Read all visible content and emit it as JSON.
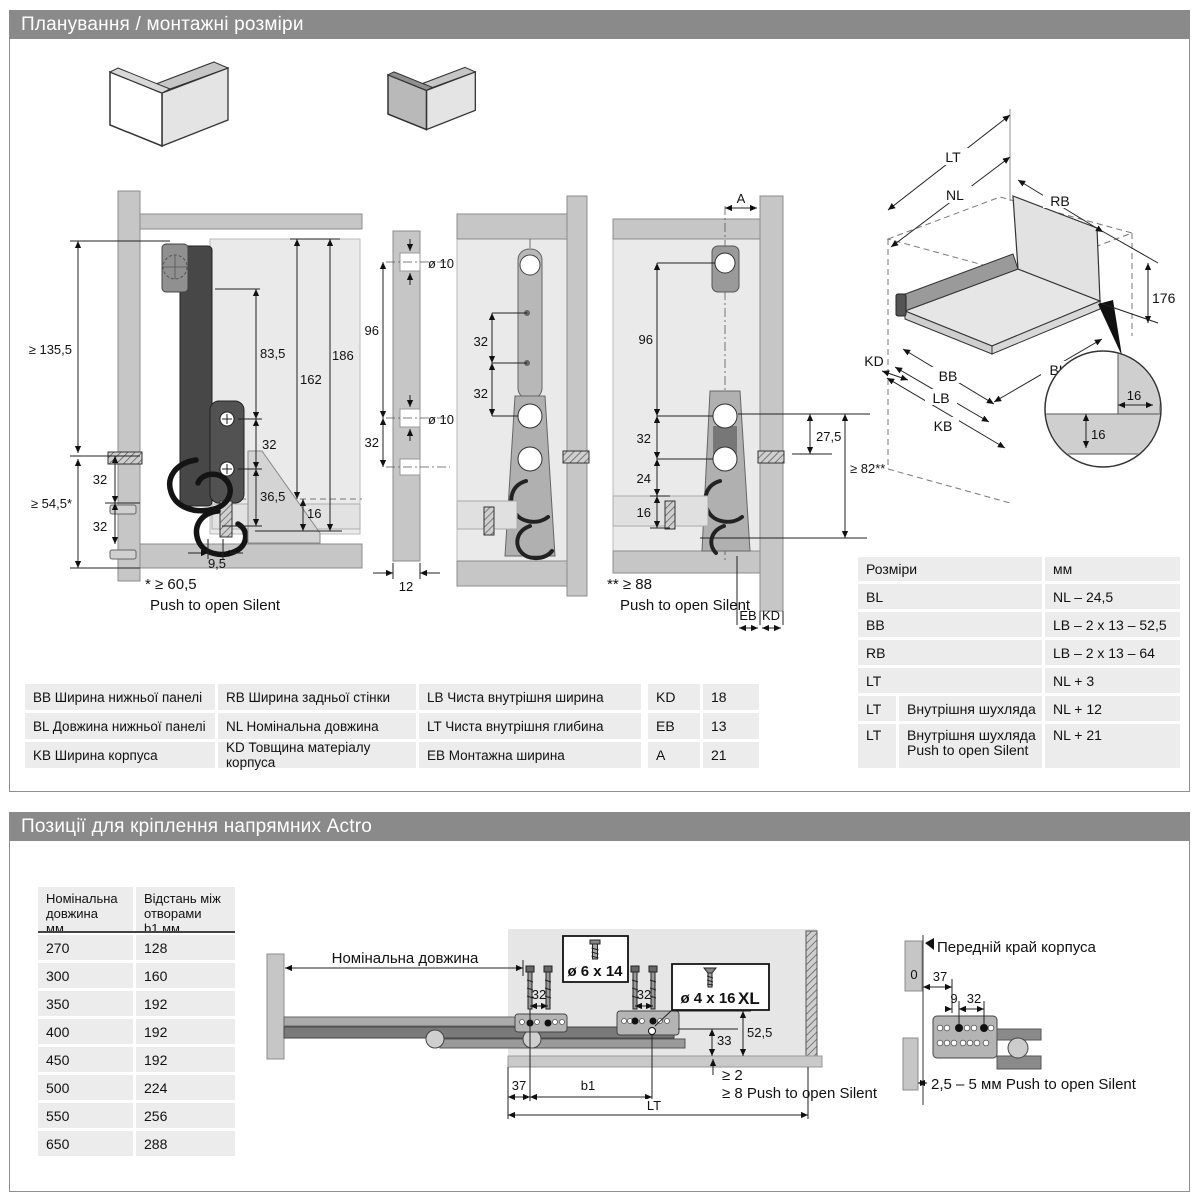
{
  "colors": {
    "header_bg": "#8a8a8a",
    "row_bg": "#ececec",
    "panel_gray": "#c6c6c6",
    "inner_gray": "#eaeaea",
    "dark_part": "#474747"
  },
  "s1": {
    "title": "Планування / монтажні розміри",
    "d1": {
      "gte1355": "≥ 135,5",
      "v32a": "32",
      "v32b": "32",
      "gte545": "≥ 54,5*",
      "v835": "83,5",
      "v162": "162",
      "v186": "186",
      "v32c": "32",
      "v365": "36,5",
      "v16": "16",
      "v95": "9,5",
      "fn1": "* ≥ 60,5",
      "fn2": "Push to open Silent"
    },
    "strip": {
      "dia1": "ø 10",
      "dia2": "ø 10",
      "v96": "96",
      "v32": "32",
      "v12": "12"
    },
    "d2": {
      "v32a": "32",
      "v32b": "32"
    },
    "d3": {
      "vA": "A",
      "v96": "96",
      "v32": "32",
      "v24": "24",
      "v16": "16",
      "v275": "27,5",
      "gte82": "≥ 82**",
      "fn1": "** ≥ 88",
      "fn2": "Push to open Silent",
      "eb": "EB",
      "kd": "KD"
    },
    "iso": {
      "lt": "LT",
      "nl": "NL",
      "rb": "RB",
      "v176": "176",
      "kd": "KD",
      "bb": "BB",
      "lb": "LB",
      "kb": "KB",
      "bl": "BL",
      "v16a": "16",
      "v16b": "16"
    },
    "legend": [
      [
        "BB Ширина нижньої панелі",
        "RB Ширина задньої стінки",
        "LB Чиста внутрішня ширина"
      ],
      [
        "BL Довжина нижньої панелі",
        "NL Номінальна довжина",
        "LT Чиста внутрішня глибина"
      ],
      [
        "KB Ширина корпуса",
        "KD Товщина матеріалу корпуса",
        "EB Монтажна ширина"
      ]
    ],
    "params": [
      [
        "KD",
        "18"
      ],
      [
        "EB",
        "13"
      ],
      [
        "A",
        "21"
      ]
    ],
    "sizes": {
      "h1": "Розміри",
      "h2": "мм",
      "rows": [
        {
          "k": "BL",
          "sub": "",
          "v": "NL – 24,5"
        },
        {
          "k": "BB",
          "sub": "",
          "v": "LB – 2 x 13 – 52,5"
        },
        {
          "k": "RB",
          "sub": "",
          "v": "LB – 2 x 13 – 64"
        },
        {
          "k": "LT",
          "sub": "",
          "v": "NL + 3"
        },
        {
          "k": "LT",
          "sub": "Внутрішня шухляда",
          "v": "NL + 12"
        },
        {
          "k": "LT",
          "sub": "Внутрішня шухляда\nPush to open Silent",
          "v": "NL + 21"
        }
      ]
    }
  },
  "s2": {
    "title": "Позиції для кріплення напрямних Actro",
    "table": {
      "h1": "Номінальна\nдовжина\nмм",
      "h2": "Відстань між\nотворами\nb1 мм",
      "rows": [
        [
          "270",
          "128"
        ],
        [
          "300",
          "160"
        ],
        [
          "350",
          "192"
        ],
        [
          "400",
          "192"
        ],
        [
          "450",
          "192"
        ],
        [
          "500",
          "224"
        ],
        [
          "550",
          "256"
        ],
        [
          "650",
          "288"
        ]
      ]
    },
    "draw": {
      "nl": "Номінальна довжина",
      "v32a": "32",
      "v32b": "32",
      "box1": "ø 6 x 14",
      "box2": "ø 4 x 16",
      "box2xl": "XL",
      "v33": "33",
      "v525": "52,5",
      "gte2": "≥ 2",
      "gte8": "≥ 8 Push to open Silent",
      "v37": "37",
      "b1": "b1",
      "lt": "LT"
    },
    "detail": {
      "edge": "Передній край корпуса",
      "v0": "0",
      "v37": "37",
      "v9": "9",
      "v32": "32",
      "note": "2,5 – 5 мм Push to open Silent"
    }
  }
}
